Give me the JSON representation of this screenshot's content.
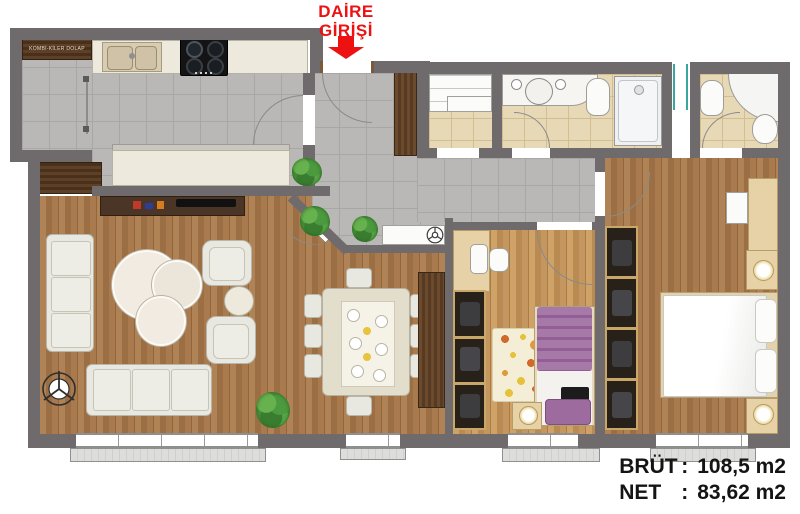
{
  "entrance_label": {
    "line1": "DAİRE",
    "line2": "GİRİŞİ"
  },
  "pantry_cabinet_label": "KOMBİ-KİLER DOLAP",
  "area_summary": {
    "brut": {
      "label": "BRÜT",
      "colon": ":",
      "value": "108,5 m2"
    },
    "net": {
      "label": "NET",
      "colon": ":",
      "value": "83,62 m2"
    }
  },
  "palette": {
    "accent_red": "#ee1111",
    "wall_gray": "#6f6b6c",
    "tile_gray": "#b9b8b6",
    "tile_beige": "#e7d8b6",
    "wood_dark": "#a87a4d",
    "wood_light": "#c49760",
    "furniture_cream": "#edeadd",
    "bed_purple": "#a06fa2",
    "window_glass_teal": "#3aa6a0"
  },
  "icons": {
    "entrance_arrow": "red-down-arrow",
    "ceiling_light": "circle-with-three-spokes",
    "floor_lamp": "circle-with-tripod",
    "plant": "green-foliage-blob"
  }
}
